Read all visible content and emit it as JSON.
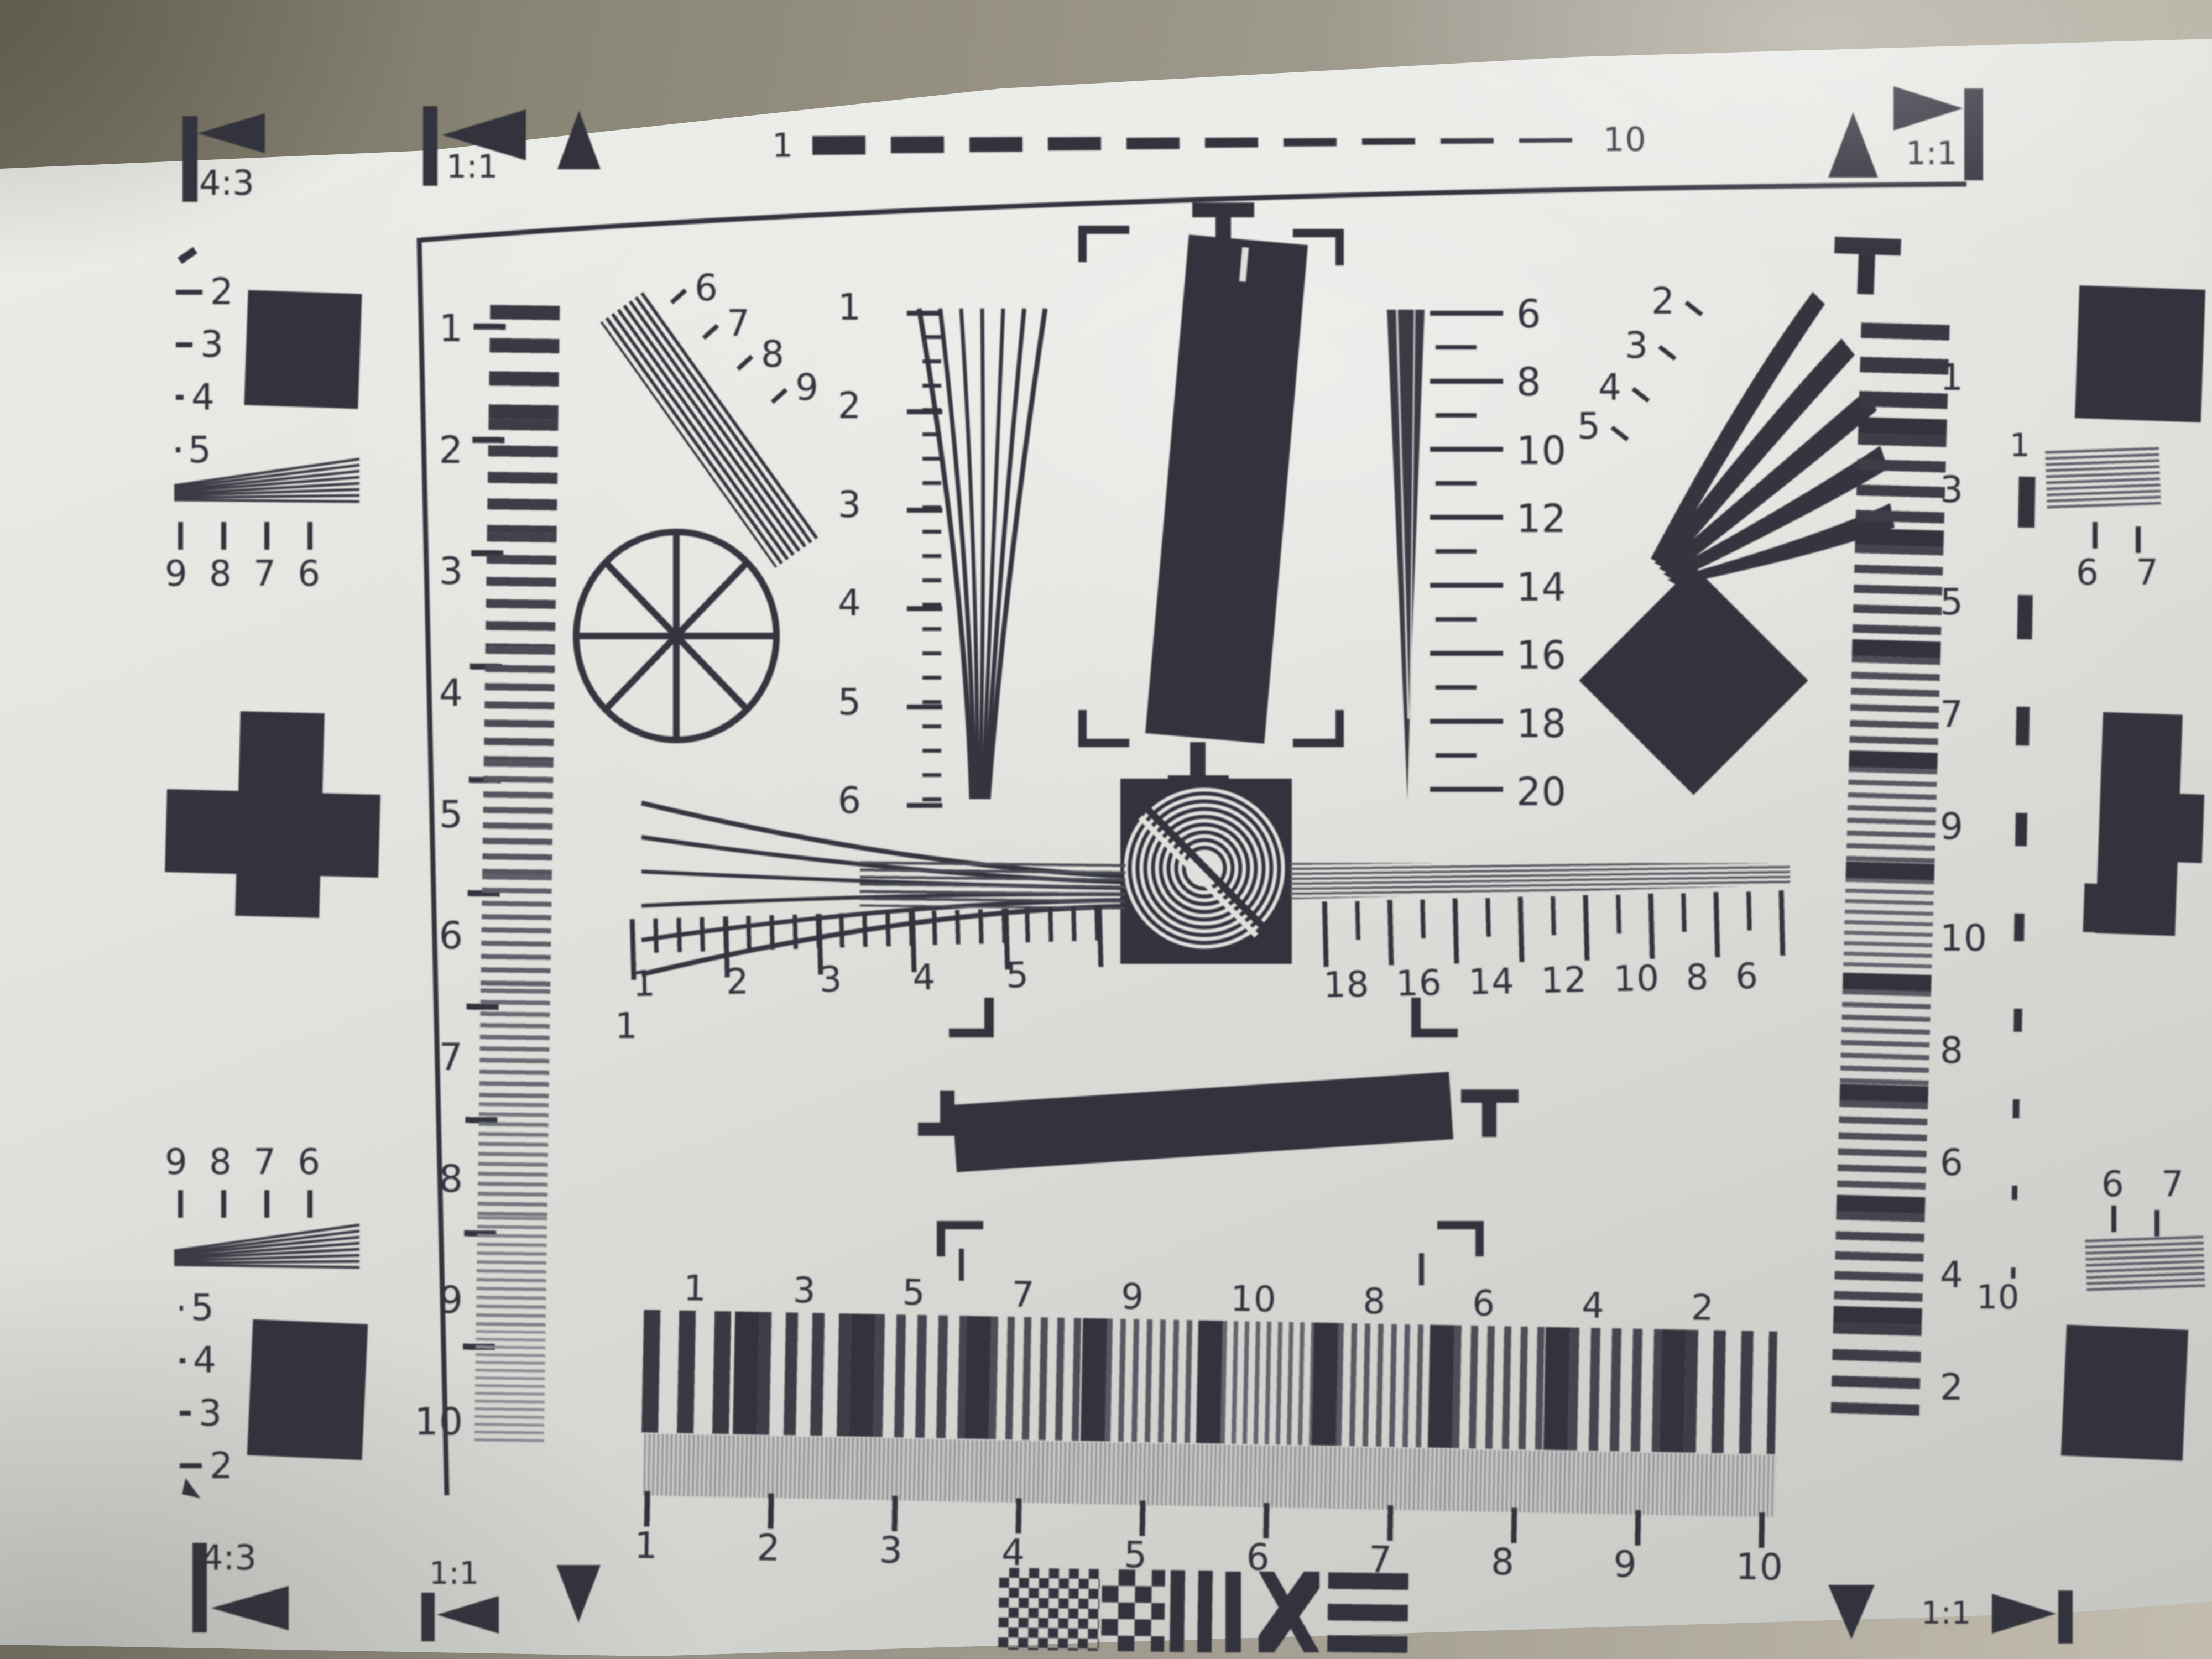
{
  "colors": {
    "ink": "#32333d",
    "paper": "#dfe1dc",
    "desk": "#8a8676"
  },
  "markers": {
    "top_left": {
      "ratio": "4:3"
    },
    "top_mid": {
      "ratio": "1:1"
    },
    "top_right": {
      "ratio": "1:1"
    },
    "bottom_left_outer": {
      "ratio": "4:3"
    },
    "bottom_left_inner": {
      "ratio": "1:1"
    },
    "bottom_right": {
      "ratio": "1:1"
    }
  },
  "top_dash_scale": {
    "start_label": "1",
    "end_label": "10"
  },
  "left_column": {
    "depth_scale_top": [
      "2",
      "3",
      "4",
      "5"
    ],
    "wedge_scale_top": [
      "9",
      "8",
      "7",
      "6"
    ],
    "wedge_scale_bottom": [
      "9",
      "8",
      "7",
      "6"
    ],
    "depth_scale_bottom": [
      "5",
      "4",
      "3",
      "2"
    ]
  },
  "left_ruler": {
    "labels": [
      "1",
      "2",
      "3",
      "4",
      "5",
      "6",
      "7",
      "8",
      "9",
      "10"
    ]
  },
  "diagonal_wedge_scale": {
    "labels": [
      "6",
      "7",
      "8",
      "9"
    ]
  },
  "vertical_wedge_scale": {
    "labels": [
      "1",
      "2",
      "3",
      "4",
      "5",
      "6"
    ]
  },
  "right_wedge_scale": {
    "labels": [
      "6",
      "8",
      "10",
      "12",
      "14",
      "16",
      "18",
      "20"
    ]
  },
  "horizontal_ruler_left": {
    "origin_label": "1",
    "labels": [
      "1",
      "2",
      "3",
      "4",
      "5"
    ]
  },
  "horizontal_ruler_right": {
    "labels": [
      "18",
      "16",
      "14",
      "12",
      "10",
      "8",
      "6"
    ]
  },
  "curved_fan_scale": {
    "labels": [
      "2",
      "3",
      "4",
      "5"
    ]
  },
  "bottom_band": {
    "labels": [
      "1",
      "3",
      "5",
      "7",
      "9",
      "10",
      "8",
      "6",
      "4",
      "2"
    ]
  },
  "bottom_ruler": {
    "labels": [
      "1",
      "2",
      "3",
      "4",
      "5",
      "6",
      "7",
      "8",
      "9",
      "10"
    ]
  },
  "right_strip": {
    "labels": [
      "1",
      "3",
      "5",
      "7",
      "9",
      "10",
      "8",
      "6",
      "4",
      "2"
    ]
  },
  "right_dash_scale": {
    "start_label": "1",
    "end_label": "10"
  },
  "right_edge": {
    "top_label": "1",
    "upper_pair": [
      "6",
      "7"
    ],
    "lower_pair": [
      "6",
      "7"
    ]
  }
}
